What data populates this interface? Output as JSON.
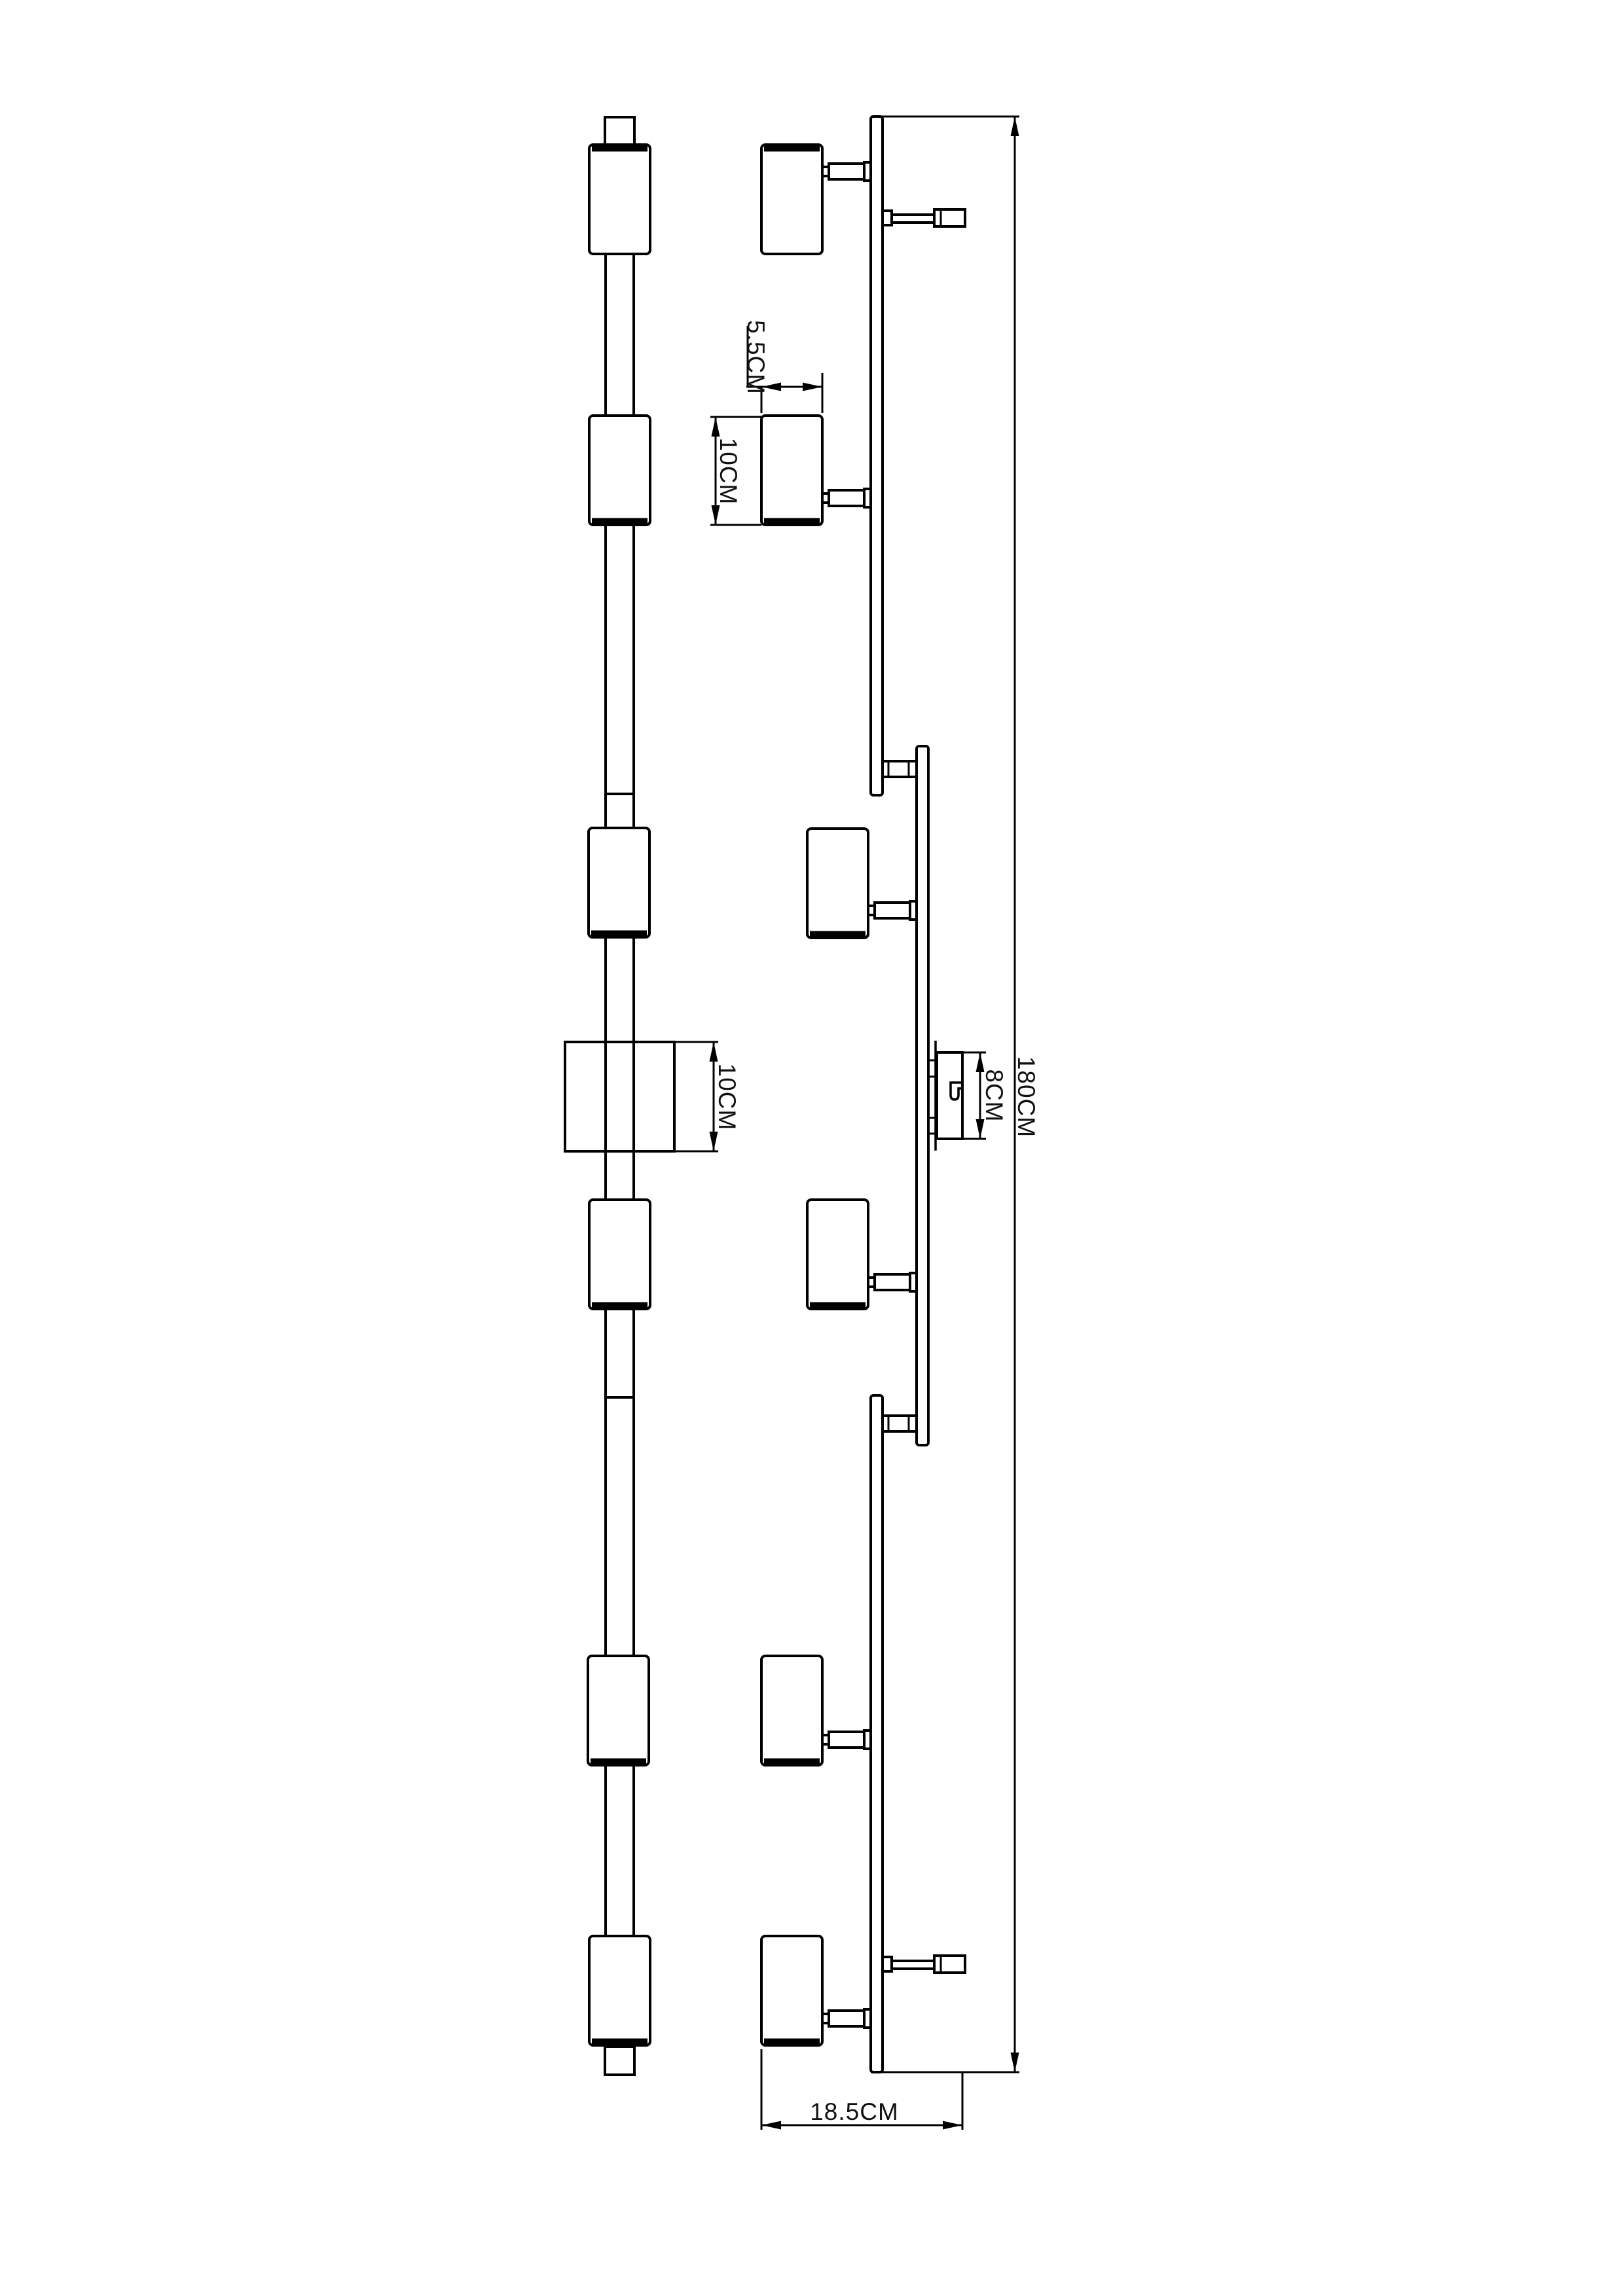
{
  "page": {
    "background": "#ffffff",
    "line_color": "#000000",
    "text_color": "#111111"
  },
  "dimensions": {
    "head_width": {
      "label": "5.5CM",
      "value_cm": 5.5
    },
    "head_height": {
      "label": "10CM",
      "value_cm": 10
    },
    "canopy_height": {
      "label": "10CM",
      "value_cm": 10
    },
    "bracket_height": {
      "label": "8CM",
      "value_cm": 8
    },
    "total_length": {
      "label": "180CM",
      "value_cm": 180
    },
    "total_depth": {
      "label": "18.5CM",
      "value_cm": 18.5
    }
  }
}
